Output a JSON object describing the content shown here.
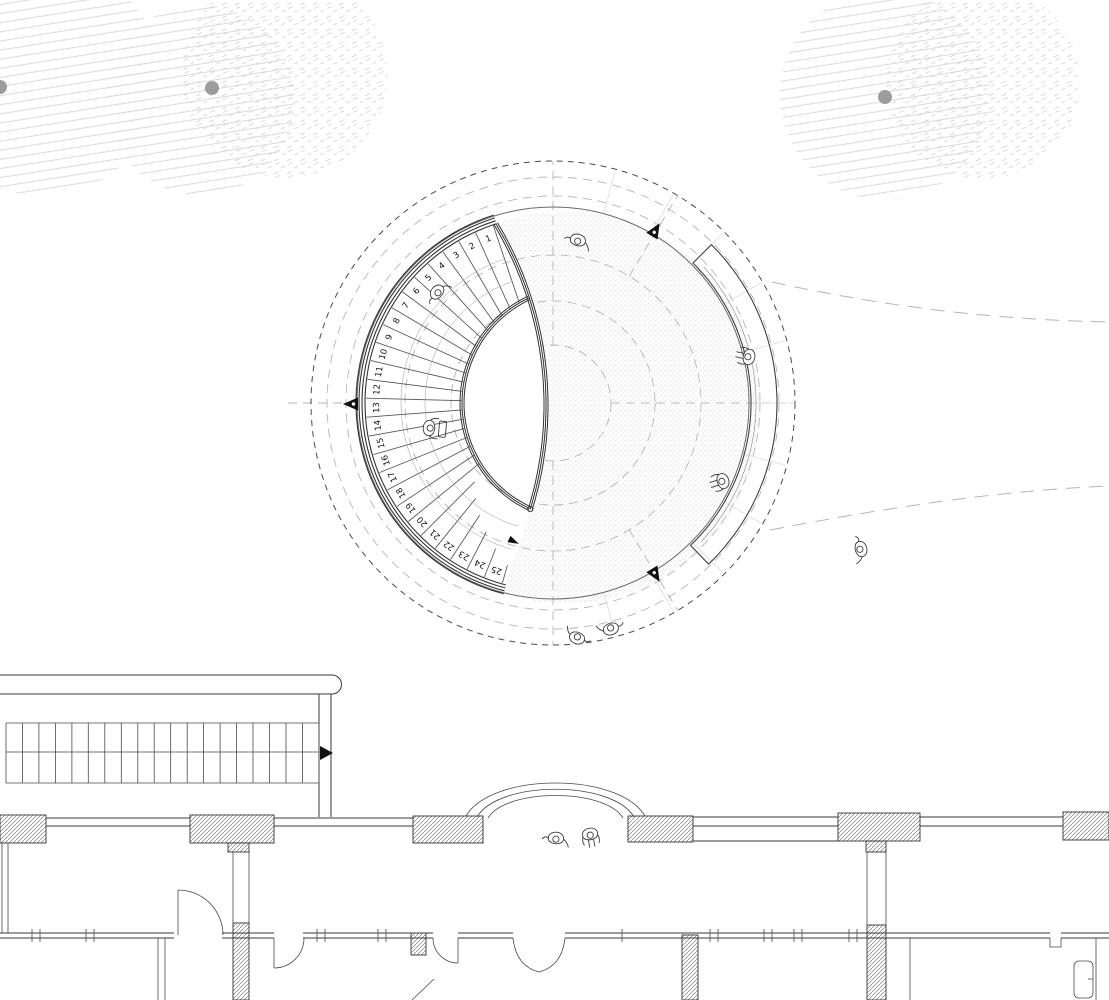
{
  "drawing": {
    "kind": "architectural-site-plan",
    "visible_text_note": "only visible text is the stair tread numbering"
  },
  "stair": {
    "tread_numbers": [
      "1",
      "2",
      "3",
      "4",
      "5",
      "6",
      "7",
      "8",
      "9",
      "10",
      "11",
      "12",
      "13",
      "14",
      "15",
      "16",
      "17",
      "18",
      "19",
      "20",
      "21",
      "22",
      "23",
      "24",
      "25"
    ],
    "tread_count": 25,
    "direction_arrow_icon": "walk-direction-arrow"
  },
  "plaza": {
    "bench_icon": "curved-bench",
    "level_marker_icon": "survey-level-marker",
    "level_markers": [
      {
        "x": 352,
        "y": 404,
        "rot": 180
      },
      {
        "x": 655,
        "y": 231,
        "rot": -59
      },
      {
        "x": 655,
        "y": 574,
        "rot": 59
      }
    ]
  },
  "people": [
    {
      "x": 578,
      "y": 240,
      "rot": 195,
      "pose": "walk"
    },
    {
      "x": 437,
      "y": 292,
      "rot": 130,
      "pose": "walk"
    },
    {
      "x": 429,
      "y": 428,
      "rot": 95,
      "pose": "frame"
    },
    {
      "x": 749,
      "y": 357,
      "rot": -78,
      "pose": "sit"
    },
    {
      "x": 723,
      "y": 481,
      "rot": -108,
      "pose": "sit"
    },
    {
      "x": 577,
      "y": 638,
      "rot": 20,
      "pose": "walk"
    },
    {
      "x": 611,
      "y": 629,
      "rot": 340,
      "pose": "walk"
    },
    {
      "x": 861,
      "y": 549,
      "rot": 255,
      "pose": "walk"
    },
    {
      "x": 556,
      "y": 838,
      "rot": 185,
      "pose": "walk"
    },
    {
      "x": 590,
      "y": 834,
      "rot": 170,
      "pose": "sit"
    }
  ],
  "trees": {
    "canopy_hatch_icon": "tree-canopy-hatch",
    "trunk_dot_icon": "tree-trunk-dot",
    "trunks": [
      {
        "x": 0,
        "y": 87
      },
      {
        "x": 212,
        "y": 88
      },
      {
        "x": 885,
        "y": 97
      }
    ]
  },
  "building": {
    "straight_stair_icon": "straight-stair",
    "entrance_canopy_icon": "entrance-canopy",
    "door_swing_icon": "door-swing",
    "sink_fixture_icon": "sink-fixture",
    "direction_arrow_icon": "stair-direction-arrow"
  },
  "colors": {
    "background": "#ffffff",
    "line_dark": "#3a3a3a",
    "dash_dark": "#4a4a4a",
    "dash_gray": "#b5b5b5",
    "rim": "#6a6a6a",
    "tread_line": "#555555",
    "tree_hatch": "#d8d8d8",
    "tree_trunk": "#9c9c9c",
    "stipple": "#c0c0c0",
    "paving_joint": "#dcdcdc",
    "marker_fill": "#111111"
  }
}
